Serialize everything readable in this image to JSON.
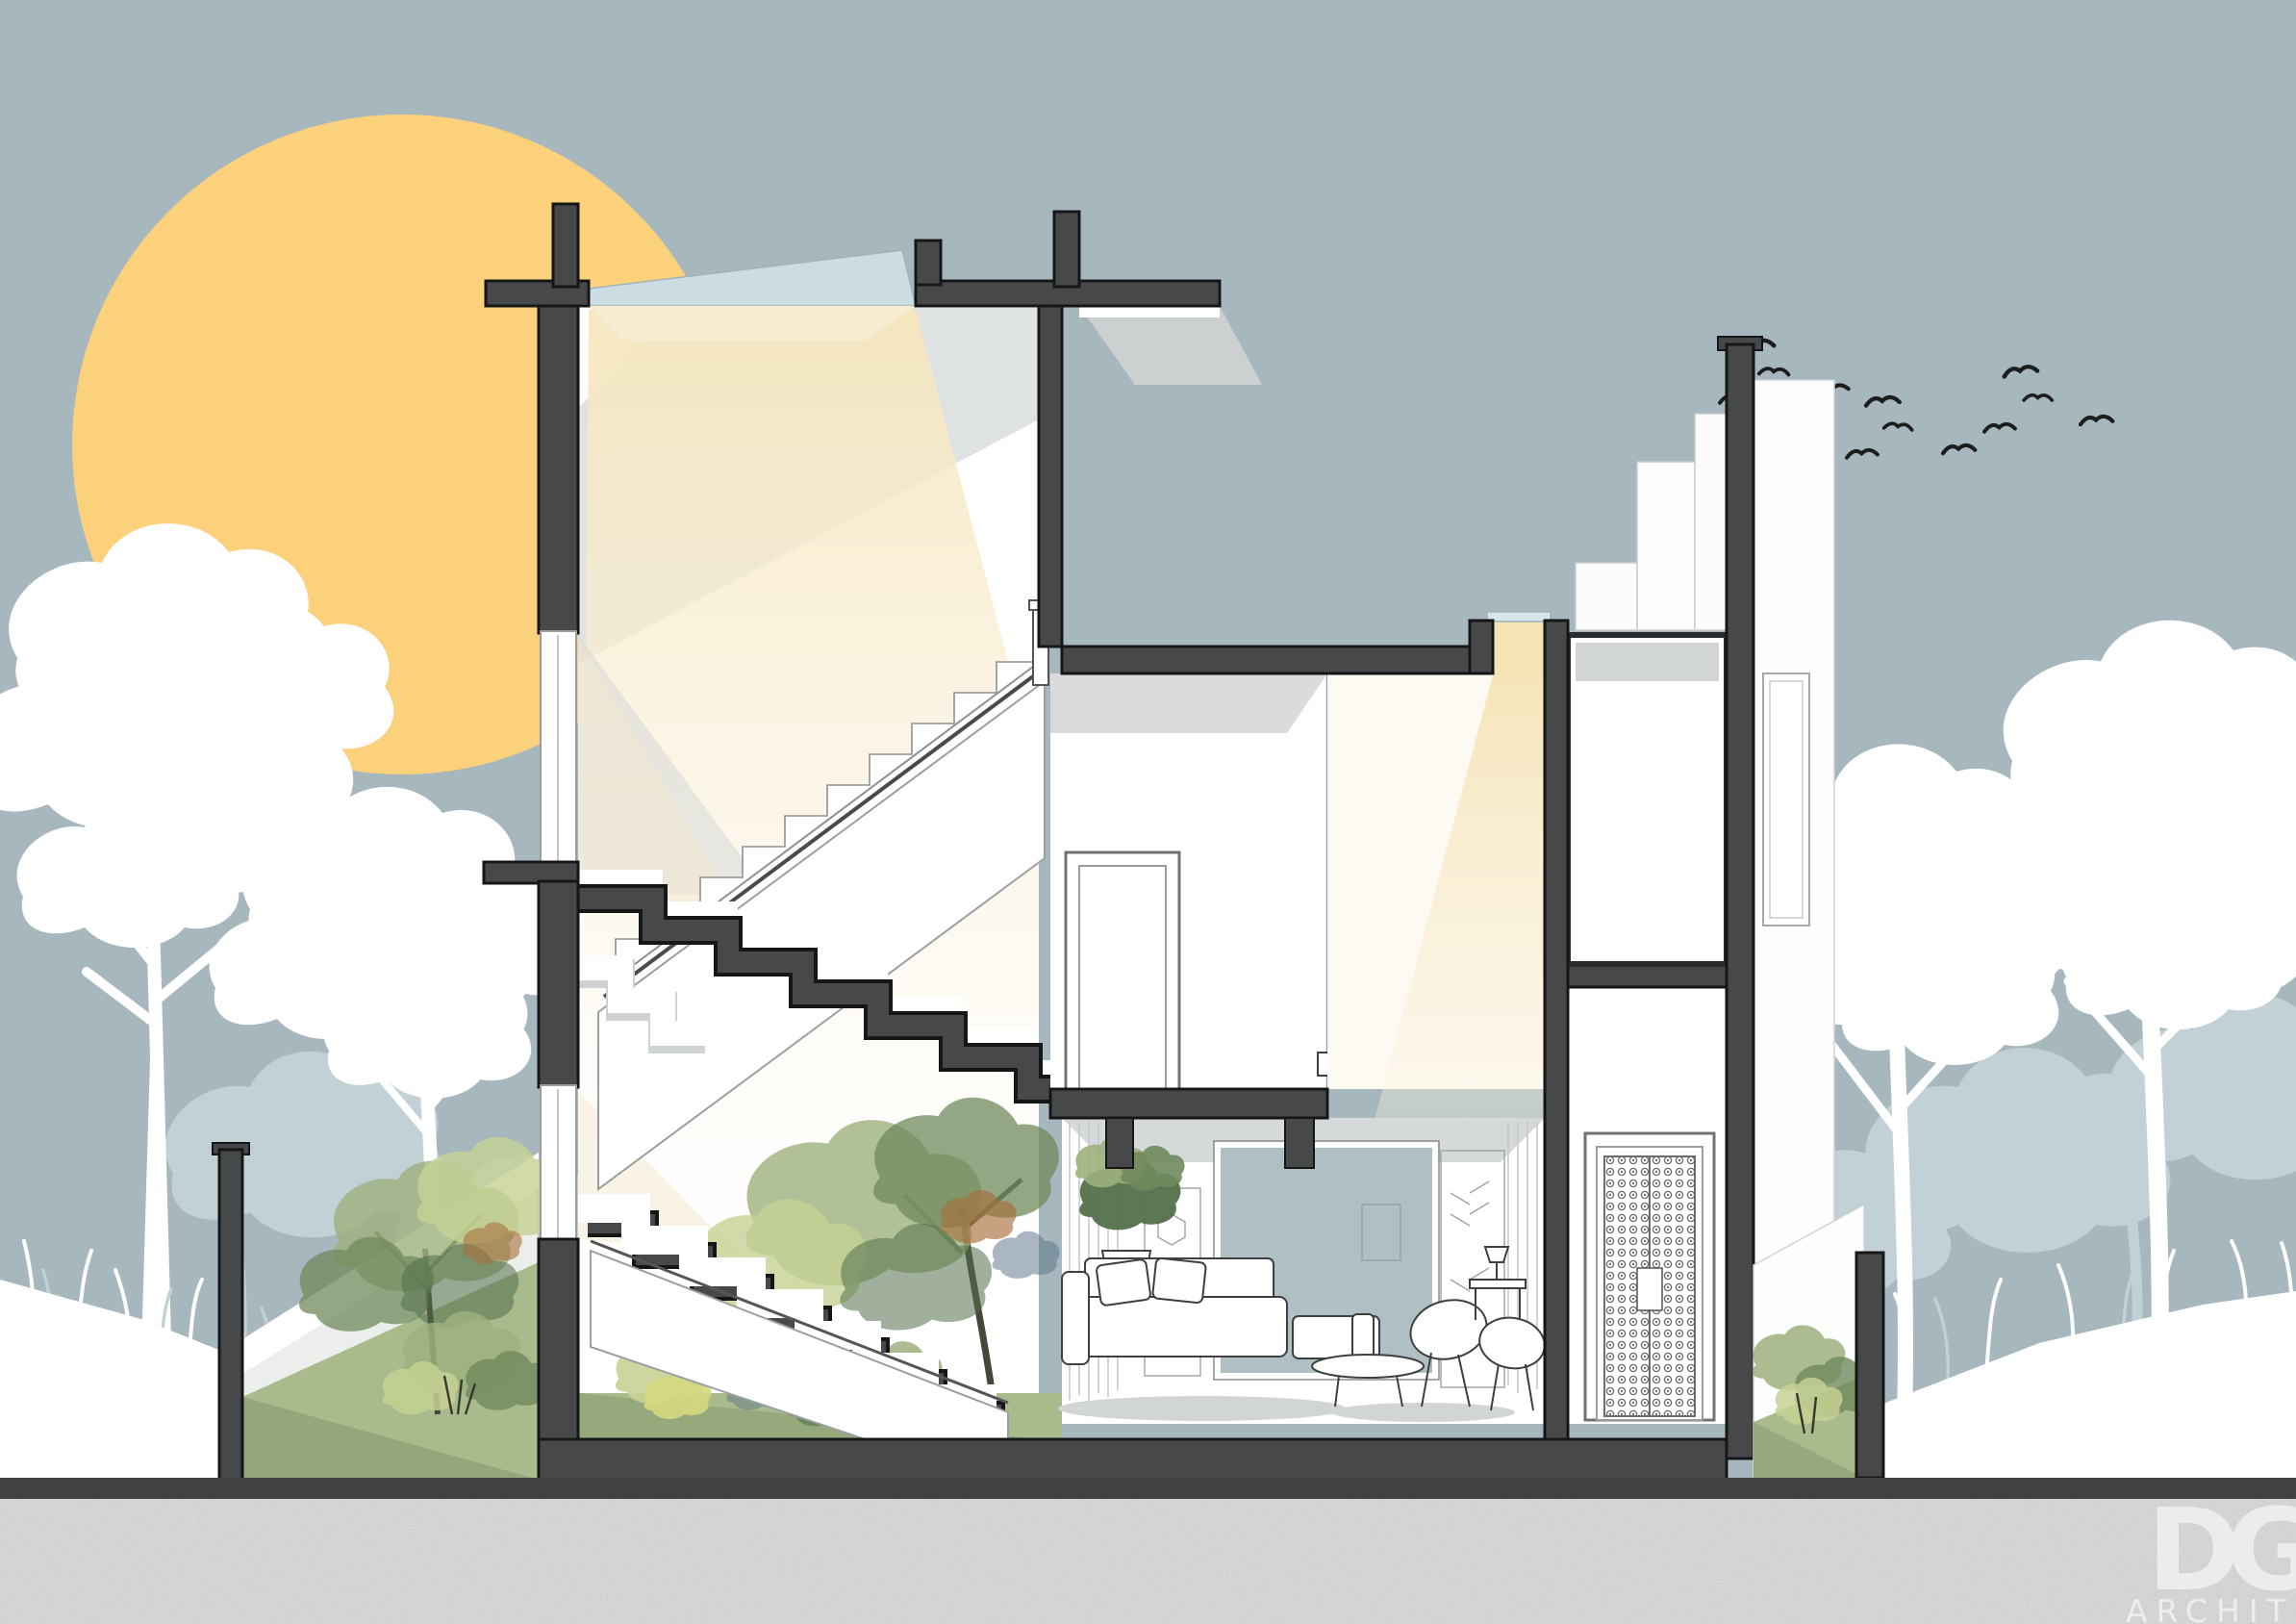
{
  "scene": {
    "type": "architectural-cross-section-illustration",
    "description": "Sectional perspective of a three-storey house with skylit stairwell, courtyard garden, living room and entry, set against a sun, white tree silhouettes and flying birds"
  },
  "colors": {
    "sky": "#a6b8bd",
    "sun": "#fcd17b",
    "wall": "#474849",
    "outline": "#161616",
    "glass": "#cbdde3",
    "beam": "#f5e3b4",
    "lawn": "#a9ba8c",
    "lawn_shade": "#8aa074",
    "ground": "#dcdddd",
    "ground_band": "#3f4142",
    "tree_white": "#ffffff",
    "tree_far": "#c2d1d5",
    "bird": "#1d1d1d",
    "watercolor_a": "#9db07c",
    "watercolor_b": "#6f8a5c",
    "watercolor_c": "#c6d193",
    "watercolor_d": "#52704b",
    "accent_rust": "#a8703c",
    "accent_blue": "#567086",
    "shadow": "#d2d5d6",
    "logo": "#f2f2f2"
  },
  "birds": {
    "count": 12
  },
  "logo": {
    "monogram": "DG",
    "label": "ARCHITECTS"
  }
}
